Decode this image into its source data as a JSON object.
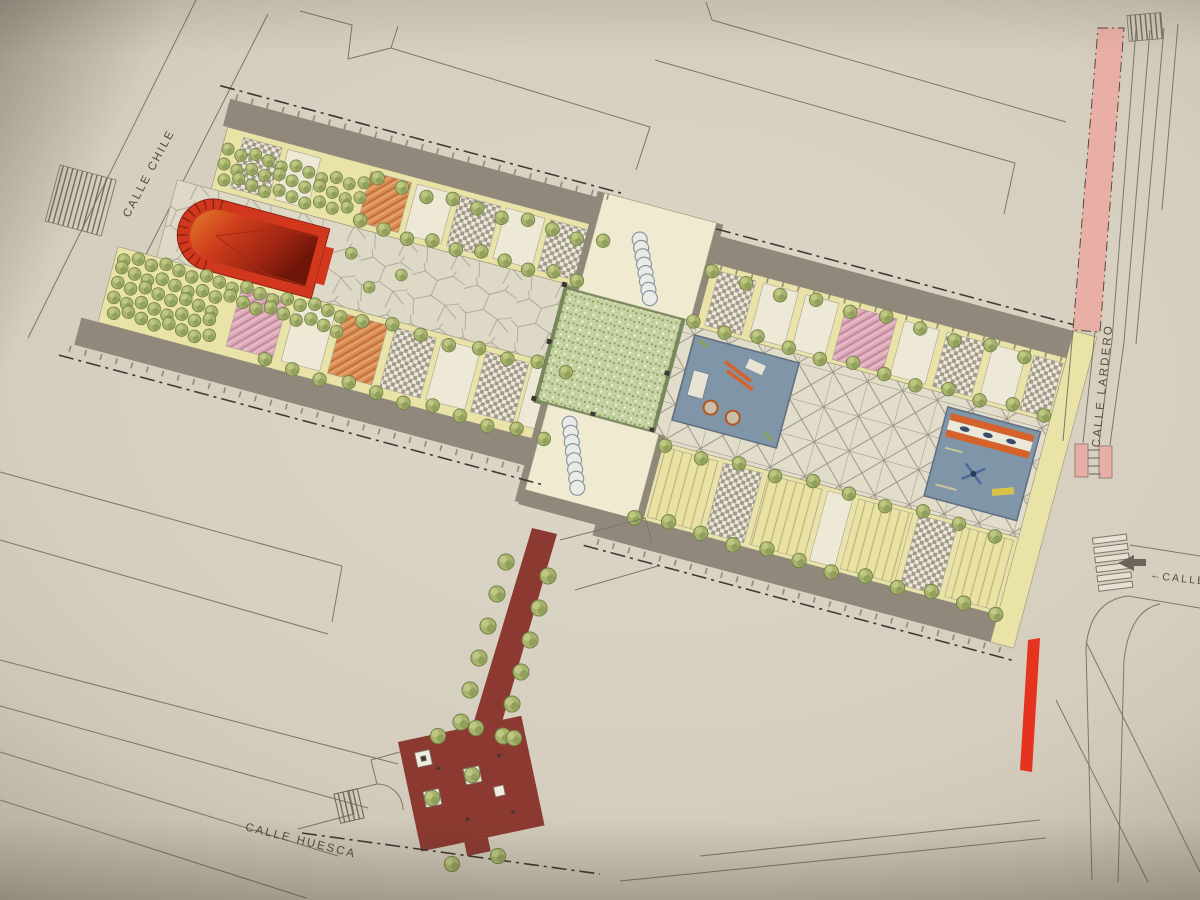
{
  "street_labels": {
    "chile": "CALLE CHILE",
    "lardero": "CALLE LARDERO",
    "huesca": "CALLE HUESCA",
    "east_partial": "CALLE S",
    "east_partial_arrow": "←"
  },
  "palette": {
    "paper": "#d7d0c0",
    "road_gray": "#8f887b",
    "path_yellow": "#e9e3a7",
    "pale_connector": "#f0ead0",
    "plain_patch": "#eee9d6",
    "parterre_border": "#77895c",
    "tree_green": "#a8b36b",
    "bandstand_red": "#d0371d",
    "bandstand_shadow": "#8e2212",
    "promenade_maroon": "#8c3a31",
    "playground_blue": "#8095a7",
    "playground_border": "#5d6f80",
    "street_pink": "#e9afa7",
    "curb_red": "#e53320",
    "ink": "#50483c"
  }
}
